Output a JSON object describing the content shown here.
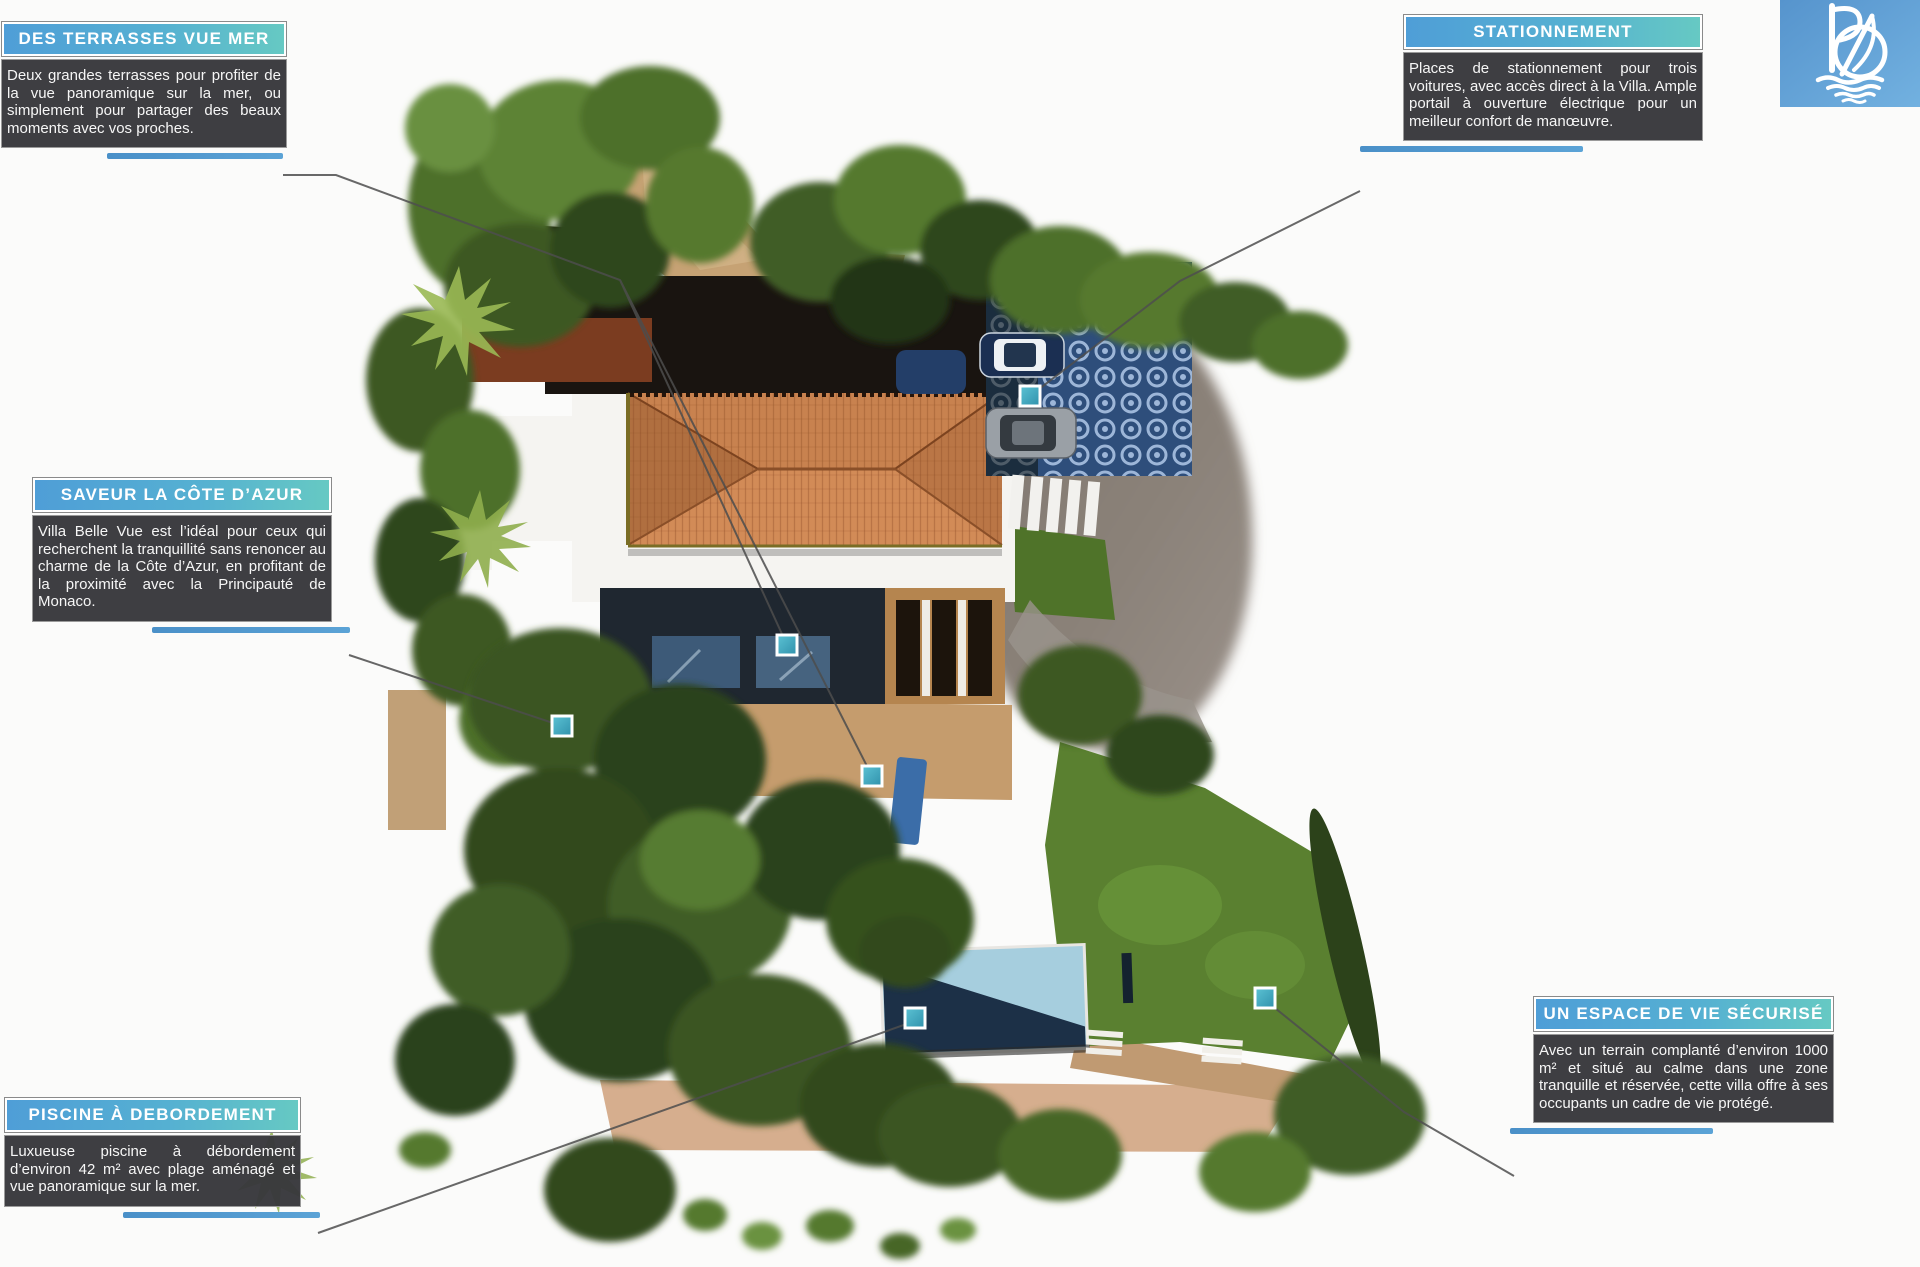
{
  "page_title": "Villa Belle Vue — plan aérien annoté",
  "callouts": [
    {
      "id": "terrasses",
      "title": "DES TERRASSES VUE MER",
      "body": "Deux grandes terrasses pour profiter de la vue panoramique sur la mer, ou simplement pour partager des beaux moments avec vos proches."
    },
    {
      "id": "stationnement",
      "title": "STATIONNEMENT",
      "body": "Places de stationnement pour trois voitures, avec accès direct à la Villa. Ample portail à ouverture électrique pour un meilleur confort de manœuvre."
    },
    {
      "id": "saveur",
      "title": "SAVEUR LA CÔTE D’AZUR",
      "body": "Villa Belle Vue est l’idéal pour ceux qui recherchent la tranquillité sans renoncer au charme de la Côte d’Azur, en profitant de la proximité avec la Principauté de Monaco."
    },
    {
      "id": "piscine",
      "title": "PISCINE À DEBORDEMENT",
      "body": "Luxueuse piscine à débordement d’environ 42 m² avec plage aménagé et vue panoramique sur la mer."
    },
    {
      "id": "espace",
      "title": "UN ESPACE DE VIE SÉCURISÉ",
      "body": "Avec un terrain complanté d’environ 1000 m² et situé au calme dans une zone tranquille et réservée, cette villa offre à ses occupants un cadre de vie protégé."
    }
  ],
  "markers": [
    {
      "feature": "stationnement",
      "x": 1030,
      "y": 396
    },
    {
      "feature": "terrasse-superieure",
      "x": 787,
      "y": 645
    },
    {
      "feature": "jardin-cote-azur",
      "x": 562,
      "y": 726
    },
    {
      "feature": "terrasse-inferieure",
      "x": 872,
      "y": 776
    },
    {
      "feature": "piscine",
      "x": 915,
      "y": 1018
    },
    {
      "feature": "espace-securise",
      "x": 1265,
      "y": 998
    }
  ],
  "logo_icon": "belle-vue-monogram-sail-water",
  "colors": {
    "header_gradient_start": "#4f9ed7",
    "header_gradient_end": "#66c9c3",
    "body_box": "#38383c",
    "underline_bar": "#5ba3d6",
    "marker_fill": "#45aec6",
    "connector_line": "#4d4d4d",
    "logo_background": "#5e9fd6"
  }
}
